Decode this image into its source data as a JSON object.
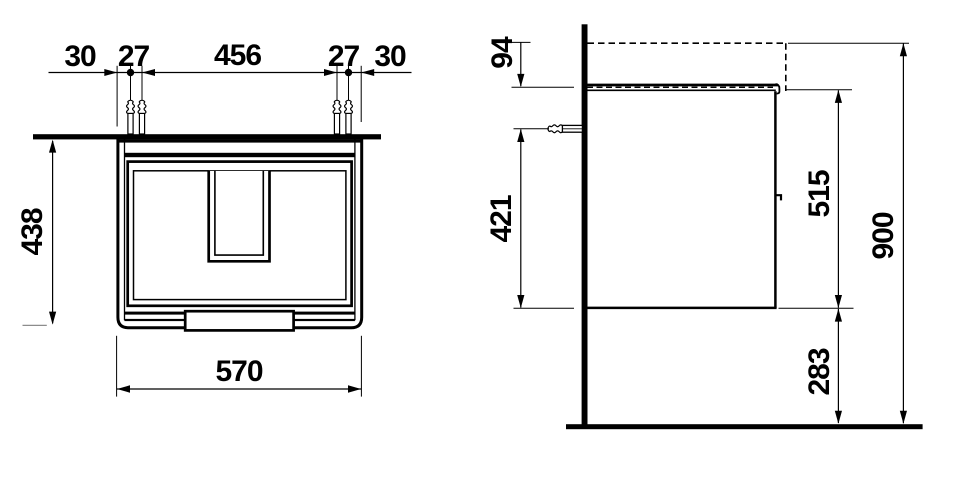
{
  "front_view": {
    "top_dimensions": [
      "30",
      "27",
      "456",
      "27",
      "30"
    ],
    "height": "438",
    "width": "570"
  },
  "side_view": {
    "top_edge_to_worktop": "94",
    "anchor_to_bottom": "421",
    "body_height": "515",
    "total_height": "900",
    "bottom_clearance": "283"
  },
  "colors": {
    "line": "#000000",
    "background": "#ffffff",
    "muted_line": "#8c8c8c"
  }
}
